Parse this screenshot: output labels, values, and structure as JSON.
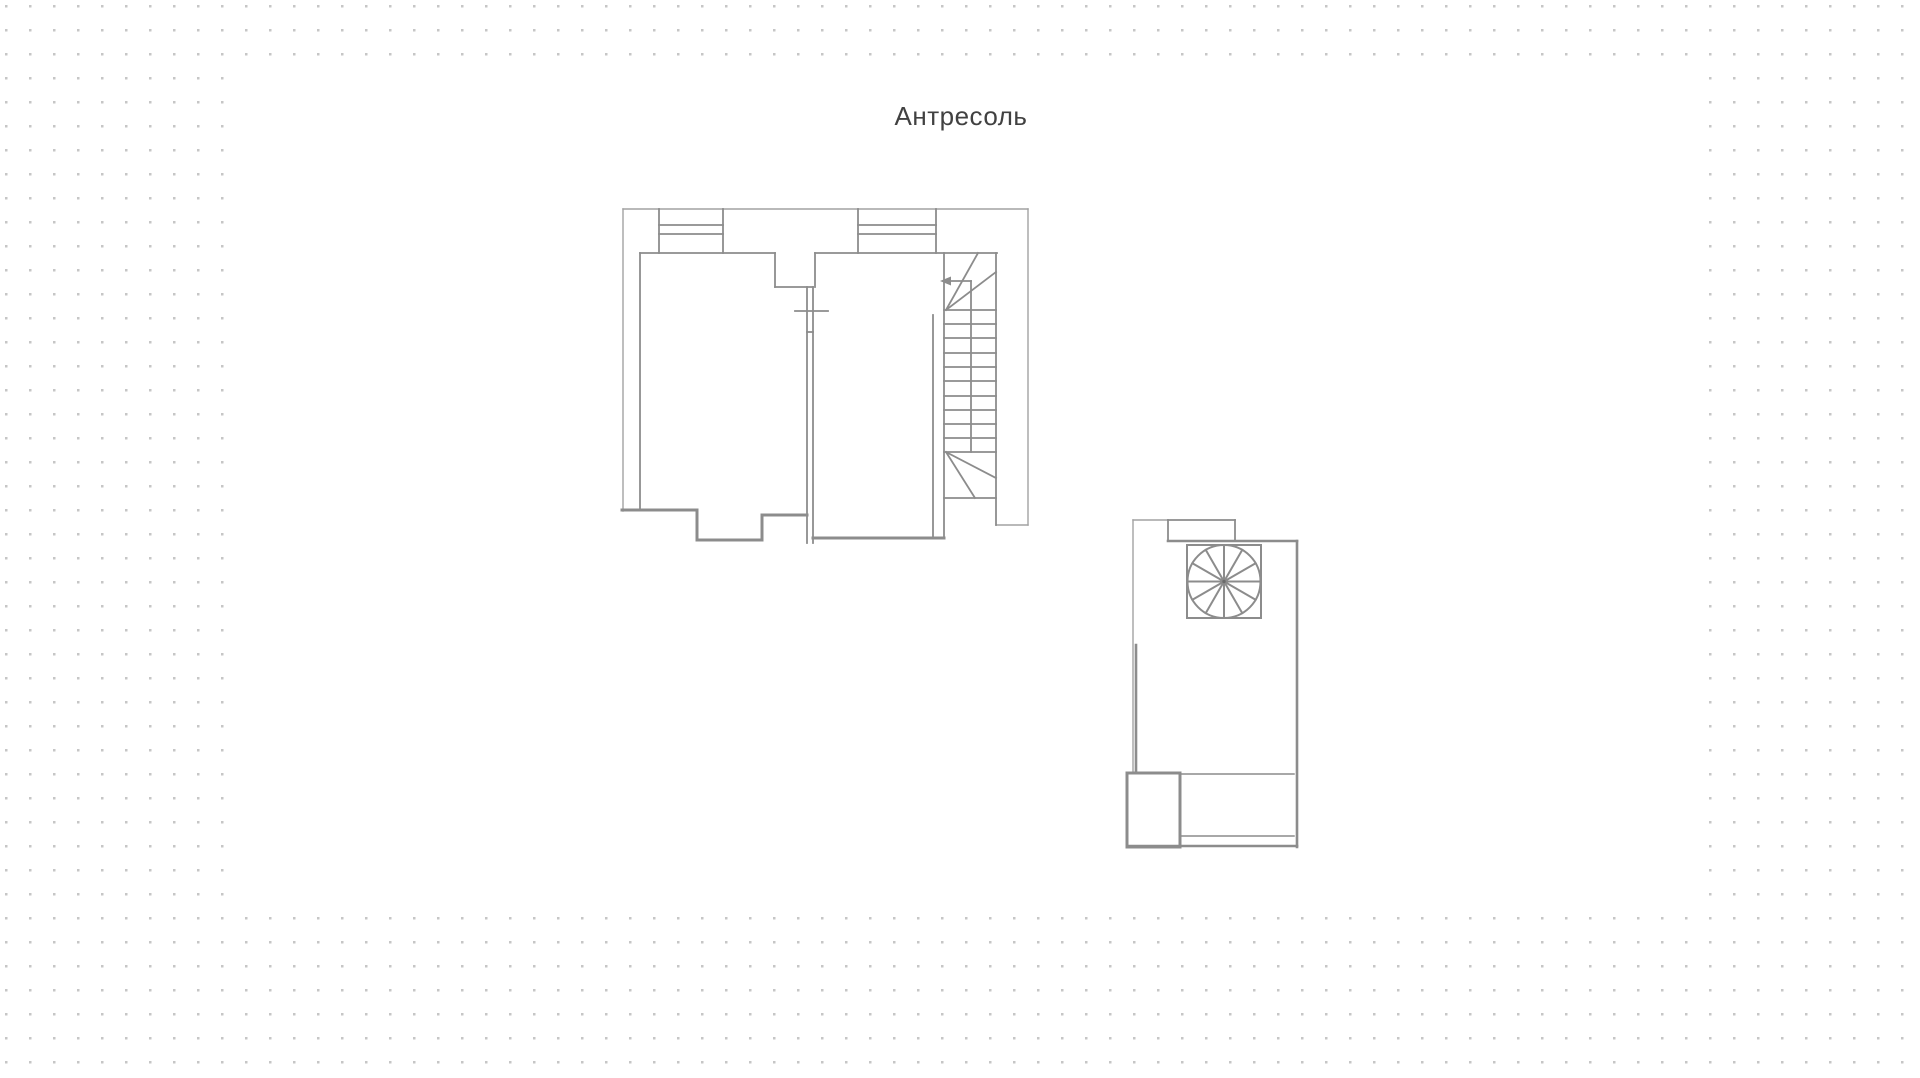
{
  "canvas": {
    "page_background": "#ffffff",
    "dot_color": "#c6c6c6",
    "dot_size": 2.5,
    "dot_spacing": 24,
    "white_area": {
      "x": 232,
      "y": 66,
      "width": 1460,
      "height": 850
    }
  },
  "title": {
    "text": "Антресоль",
    "color": "#414141",
    "font_size": 26
  },
  "plan": {
    "stroke_color": "#8c8c8c",
    "outline_color": "#a2a2a2",
    "units": [
      {
        "name": "main-unit",
        "groups": [
          {
            "name": "outer-outline",
            "width": 1.4,
            "color": "#a2a2a2",
            "segments": [
              [
                623,
                209,
                1028,
                209
              ],
              [
                1028,
                209,
                1028,
                525
              ],
              [
                996,
                525,
                1028,
                525
              ],
              [
                623,
                209,
                623,
                511
              ]
            ]
          },
          {
            "name": "windows",
            "width": 1.8,
            "segments": [
              [
                659,
                209,
                659,
                253
              ],
              [
                723,
                209,
                723,
                253
              ],
              [
                659,
                225,
                723,
                225
              ],
              [
                659,
                234,
                723,
                234
              ],
              [
                858,
                209,
                858,
                253
              ],
              [
                936,
                209,
                936,
                253
              ],
              [
                858,
                225,
                936,
                225
              ],
              [
                858,
                234,
                936,
                234
              ]
            ]
          },
          {
            "name": "interior-walls",
            "width": 1.8,
            "segments": [
              [
                640,
                253,
                775,
                253
              ],
              [
                640,
                253,
                640,
                510
              ],
              [
                815,
                253,
                997,
                253
              ],
              [
                775,
                253,
                775,
                287
              ],
              [
                775,
                287,
                813,
                287
              ],
              [
                815,
                253,
                815,
                287
              ],
              [
                807,
                287,
                807,
                543
              ],
              [
                813,
                287,
                813,
                543
              ],
              [
                795,
                311,
                828,
                311
              ],
              [
                807,
                332,
                813,
                332
              ],
              [
                933,
                315,
                933,
                538
              ]
            ]
          },
          {
            "name": "thick-walls",
            "width": 3,
            "segments": [
              [
                622,
                510,
                697,
                510
              ],
              [
                697,
                510,
                697,
                540
              ],
              [
                697,
                540,
                762,
                540
              ],
              [
                762,
                540,
                762,
                515
              ],
              [
                762,
                515,
                807,
                515
              ],
              [
                813,
                538,
                944,
                538
              ]
            ]
          },
          {
            "name": "staircase",
            "width": 1.8,
            "segments": [
              [
                944,
                253,
                944,
                538
              ],
              [
                996,
                253,
                996,
                525
              ],
              [
                971,
                281,
                971,
                452
              ],
              [
                951,
                281,
                971,
                281
              ],
              [
                946,
                310,
                978,
                253
              ],
              [
                946,
                310,
                996,
                272
              ],
              [
                944,
                310,
                996,
                310
              ],
              [
                944,
                324,
                996,
                324
              ],
              [
                944,
                338,
                996,
                338
              ],
              [
                944,
                353,
                996,
                353
              ],
              [
                944,
                367,
                996,
                367
              ],
              [
                944,
                381,
                996,
                381
              ],
              [
                944,
                396,
                996,
                396
              ],
              [
                944,
                410,
                996,
                410
              ],
              [
                944,
                424,
                996,
                424
              ],
              [
                944,
                438,
                996,
                438
              ],
              [
                944,
                452,
                996,
                452
              ],
              [
                946,
                452,
                996,
                478
              ],
              [
                946,
                452,
                975,
                498
              ],
              [
                944,
                498,
                996,
                498
              ]
            ]
          }
        ],
        "polygons": [
          {
            "name": "stair-direction-arrowhead",
            "points": "940,281 951,276.5 951,285.5"
          }
        ]
      },
      {
        "name": "stair-unit",
        "groups": [
          {
            "name": "outer-outline",
            "width": 1.4,
            "color": "#a2a2a2",
            "segments": [
              [
                1133,
                520,
                1168,
                520
              ],
              [
                1133,
                520,
                1133,
                773
              ]
            ]
          },
          {
            "name": "window",
            "width": 1.8,
            "segments": [
              [
                1168,
                520,
                1235,
                520
              ],
              [
                1168,
                520,
                1168,
                541
              ],
              [
                1235,
                520,
                1235,
                541
              ]
            ]
          },
          {
            "name": "walls",
            "width": 2.6,
            "segments": [
              [
                1168,
                541,
                1297,
                541
              ],
              [
                1297,
                541,
                1297,
                847
              ],
              [
                1127,
                846,
                1297,
                846
              ],
              [
                1136,
                645,
                1136,
                773
              ]
            ]
          },
          {
            "name": "closet",
            "width": 3,
            "segments": [
              [
                1127,
                773,
                1180,
                773
              ],
              [
                1127,
                773,
                1127,
                847
              ],
              [
                1180,
                773,
                1180,
                847
              ],
              [
                1127,
                847,
                1180,
                847
              ]
            ]
          },
          {
            "name": "interior-lines",
            "width": 1.5,
            "segments": [
              [
                1180,
                774,
                1294,
                774
              ],
              [
                1180,
                836,
                1294,
                836
              ]
            ]
          },
          {
            "name": "spiral-enclosure",
            "width": 2,
            "segments": [
              [
                1187,
                545,
                1261,
                545
              ],
              [
                1187,
                618,
                1261,
                618
              ],
              [
                1187,
                545,
                1187,
                618
              ],
              [
                1261,
                545,
                1261,
                618
              ]
            ]
          }
        ],
        "spiral": {
          "cx": 1224,
          "cy": 581.5,
          "r": 36.5,
          "spokes": 12,
          "width": 2
        }
      }
    ]
  }
}
